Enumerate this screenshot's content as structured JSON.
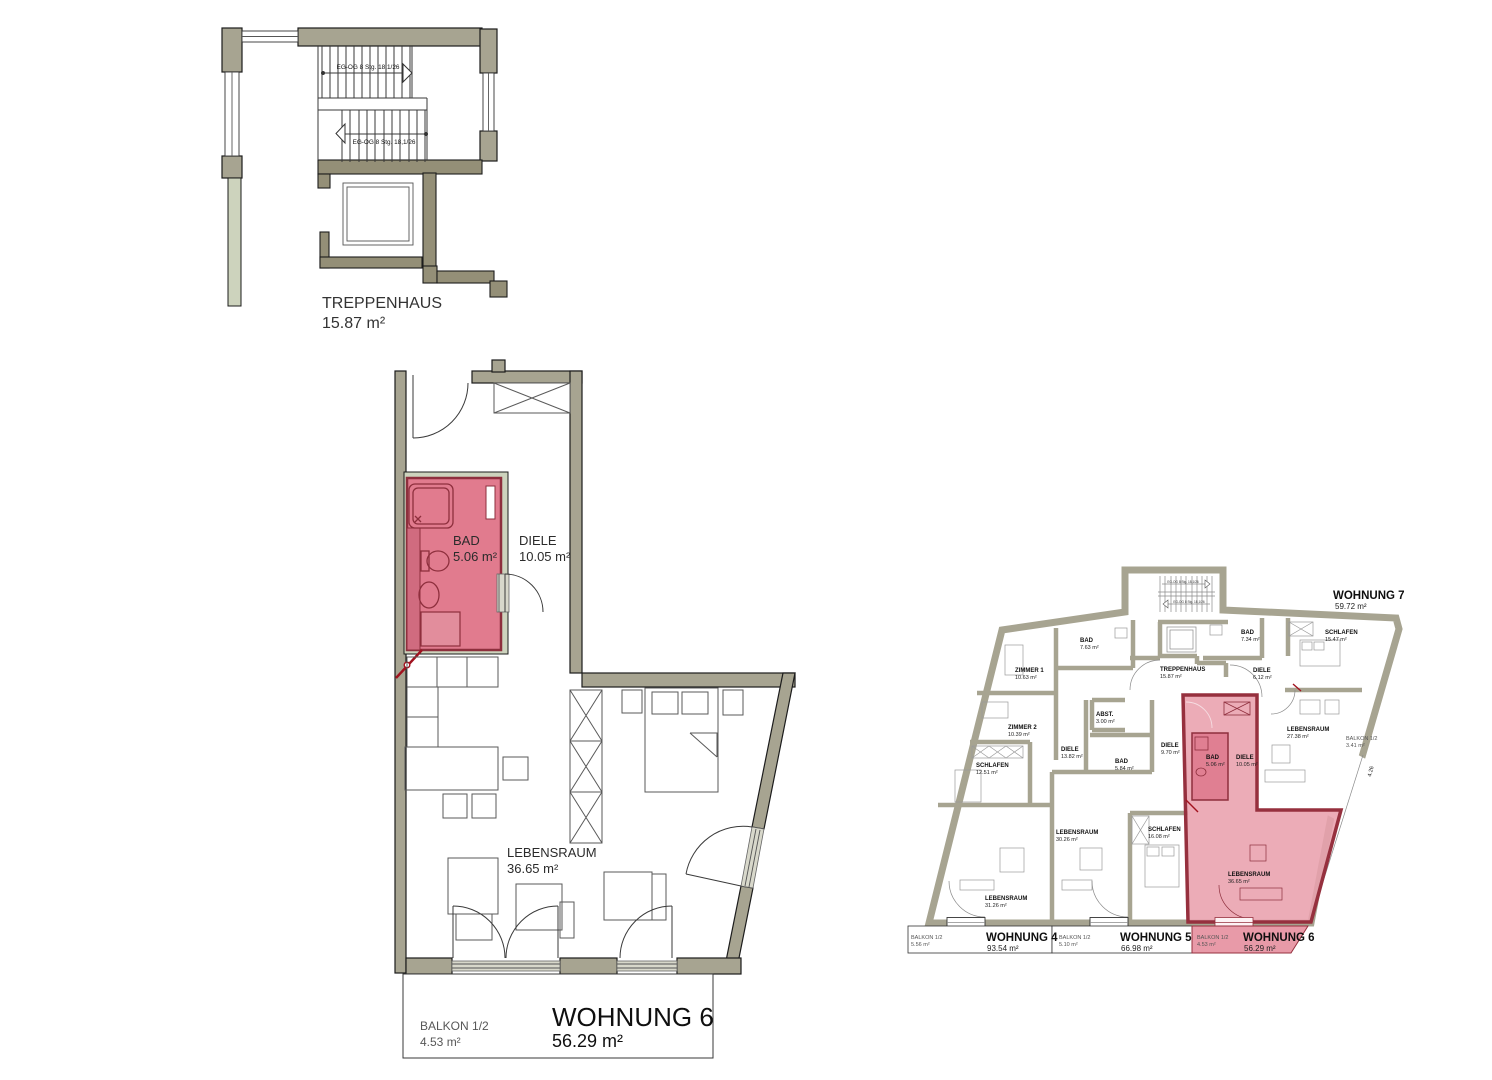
{
  "document": {
    "type": "architectural floor plan"
  },
  "colors": {
    "wall_olive": "#a7a491",
    "wall_dark_olive": "#948f77",
    "wall_light_sage": "#cdd3bd",
    "highlight_pink": "#e17b8e",
    "highlight_wall_maroon": "#8e2f3d",
    "overlay_pink": "#e9a0ad",
    "marker_red": "#a1121f"
  },
  "stairwell_plan": {
    "room": "TREPPENHAUS",
    "area": "15.87 m²",
    "stair_up_note": "EG-OG 8 Stg. 18,1/26",
    "stair_down_note": "EG-OG 8 Stg. 18,1/26"
  },
  "apartment_plan": {
    "name": "WOHNUNG 6",
    "area": "56.29 m²",
    "bad": {
      "name": "BAD",
      "area": "5.06 m²"
    },
    "diele": {
      "name": "DIELE",
      "area": "10.05 m²"
    },
    "lebensraum": {
      "name": "LEBENSRAUM",
      "area": "36.65 m²"
    },
    "balkon": {
      "name": "BALKON 1/2",
      "area": "4.53 m²"
    }
  },
  "overview_plan": {
    "stair_note": "EG-OG 8 Stg. 18,1/26",
    "treppenhaus": {
      "name": "TREPPENHAUS",
      "area": "15.87 m²"
    },
    "wohnung7": {
      "name": "WOHNUNG 7",
      "area": "59.72 m²",
      "bad": {
        "name": "BAD",
        "area": "7.34 m²"
      },
      "diele": {
        "name": "DIELE",
        "area": "6.12 m²"
      },
      "schlafen": {
        "name": "SCHLAFEN",
        "area": "15.47 m²"
      },
      "lebensraum": {
        "name": "LEBENSRAUM",
        "area": "27.38 m²"
      },
      "balkon": {
        "name": "BALKON 1/2",
        "area": "3.41 m²"
      },
      "balkon_dim": "4.26"
    },
    "wohnung4": {
      "name": "WOHNUNG 4",
      "area": "93.54 m²",
      "zimmer1": {
        "name": "ZIMMER 1",
        "area": "10.63 m²"
      },
      "zimmer2": {
        "name": "ZIMMER 2",
        "area": "10.39 m²"
      },
      "schlafen": {
        "name": "SCHLAFEN",
        "area": "12.51 m²"
      },
      "bad": {
        "name": "BAD",
        "area": "7.63 m²"
      },
      "abst": {
        "name": "ABST.",
        "area": "3.00 m²"
      },
      "diele": {
        "name": "DIELE",
        "area": "13.82 m²"
      },
      "lebensraum": {
        "name": "LEBENSRAUM",
        "area": "31.26 m²"
      },
      "balkon": {
        "name": "BALKON 1/2",
        "area": "5.56 m²"
      }
    },
    "wohnung5": {
      "name": "WOHNUNG 5",
      "area": "66.98 m²",
      "diele": {
        "name": "DIELE",
        "area": "9.70 m²"
      },
      "bad": {
        "name": "BAD",
        "area": "5.84 m²"
      },
      "schlafen": {
        "name": "SCHLAFEN",
        "area": "16.08 m²"
      },
      "lebensraum": {
        "name": "LEBENSRAUM",
        "area": "30.26 m²"
      },
      "balkon": {
        "name": "BALKON 1/2",
        "area": "5.10 m²"
      }
    },
    "wohnung6": {
      "name": "WOHNUNG 6",
      "area": "56.29 m²",
      "bad": {
        "name": "BAD",
        "area": "5.06 m²"
      },
      "diele": {
        "name": "DIELE",
        "area": "10.05 m²"
      },
      "lebensraum": {
        "name": "LEBENSRAUM",
        "area": "36.65 m²"
      },
      "balkon": {
        "name": "BALKON 1/2",
        "area": "4.53 m²"
      }
    }
  }
}
